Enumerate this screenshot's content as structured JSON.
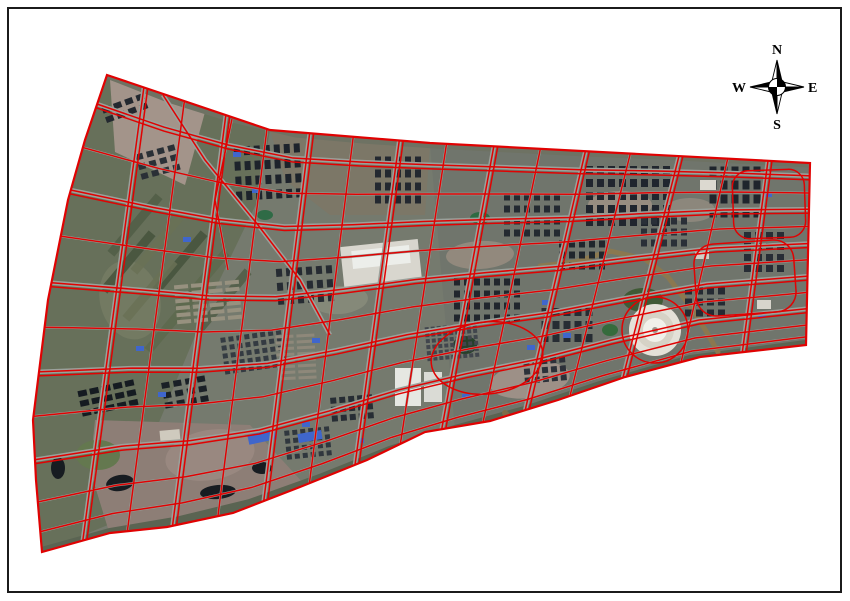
{
  "figure": {
    "type": "satellite-parcel-map",
    "bg": "#ffffff",
    "frame": {
      "inset": 8,
      "width": 833,
      "height": 584,
      "border_color": "#1b1b1b",
      "border_width": 2
    }
  },
  "compass": {
    "cx": 777,
    "cy": 87,
    "arm": 27,
    "circle_r": 8.5,
    "color": "#000000",
    "labels": {
      "north": "N",
      "south": "S",
      "east": "E",
      "west": "W"
    }
  },
  "map": {
    "base_color": "#757a6e",
    "boundary_color": "#e00202",
    "road_color": "#9ba19b",
    "outline": [
      [
        107,
        75
      ],
      [
        270,
        130
      ],
      [
        430,
        143
      ],
      [
        810,
        163
      ],
      [
        806,
        345
      ],
      [
        700,
        357
      ],
      [
        625,
        377
      ],
      [
        558,
        400
      ],
      [
        490,
        421
      ],
      [
        425,
        432
      ],
      [
        367,
        460
      ],
      [
        300,
        487
      ],
      [
        233,
        513
      ],
      [
        167,
        527
      ],
      [
        110,
        533
      ],
      [
        42,
        552
      ],
      [
        36,
        480
      ],
      [
        33,
        420
      ],
      [
        48,
        300
      ],
      [
        68,
        200
      ],
      [
        85,
        140
      ]
    ],
    "grid": {
      "top": [
        [
          107,
          75
        ],
        [
          168,
          99
        ],
        [
          232,
          119
        ],
        [
          296,
          134
        ],
        [
          363,
          140
        ],
        [
          435,
          145
        ],
        [
          510,
          149
        ],
        [
          585,
          153
        ],
        [
          660,
          156
        ],
        [
          735,
          160
        ],
        [
          808,
          164
        ]
      ],
      "bottom": [
        [
          42,
          552
        ],
        [
          110,
          533
        ],
        [
          180,
          521
        ],
        [
          250,
          504
        ],
        [
          320,
          479
        ],
        [
          390,
          451
        ],
        [
          455,
          430
        ],
        [
          525,
          411
        ],
        [
          600,
          386
        ],
        [
          690,
          360
        ],
        [
          806,
          345
        ]
      ],
      "verticals": [
        {
          "u": 0.06,
          "major": true
        },
        {
          "u": 0.125,
          "major": false
        },
        {
          "u": 0.19,
          "major": true
        },
        {
          "u": 0.255,
          "major": false
        },
        {
          "u": 0.32,
          "major": true
        },
        {
          "u": 0.385,
          "major": false
        },
        {
          "u": 0.45,
          "major": true
        },
        {
          "u": 0.515,
          "major": false
        },
        {
          "u": 0.578,
          "major": true
        },
        {
          "u": 0.64,
          "major": false
        },
        {
          "u": 0.7,
          "major": true
        },
        {
          "u": 0.76,
          "major": false
        },
        {
          "u": 0.825,
          "major": true
        },
        {
          "u": 0.89,
          "major": false
        },
        {
          "u": 0.945,
          "major": true
        }
      ],
      "horizontals": [
        {
          "v": 0.065,
          "major": true
        },
        {
          "v": 0.16,
          "major": false
        },
        {
          "v": 0.25,
          "major": true
        },
        {
          "v": 0.345,
          "major": false
        },
        {
          "v": 0.44,
          "major": true
        },
        {
          "v": 0.53,
          "major": false
        },
        {
          "v": 0.62,
          "major": true
        },
        {
          "v": 0.71,
          "major": false
        },
        {
          "v": 0.8,
          "major": true
        },
        {
          "v": 0.89,
          "major": false
        },
        {
          "v": 0.955,
          "major": false
        }
      ]
    },
    "zones": [
      {
        "points": [
          [
            107,
            75
          ],
          [
            270,
            130
          ],
          [
            258,
            200
          ],
          [
            210,
            300
          ],
          [
            160,
            420
          ],
          [
            120,
            520
          ],
          [
            42,
            552
          ],
          [
            33,
            420
          ],
          [
            48,
            300
          ],
          [
            68,
            200
          ],
          [
            85,
            140
          ]
        ],
        "fill": "#67705a"
      },
      {
        "points": [
          [
            270,
            130
          ],
          [
            430,
            145
          ],
          [
            425,
            215
          ],
          [
            330,
            215
          ],
          [
            285,
            180
          ]
        ],
        "fill": "#7c7767"
      },
      {
        "points": [
          [
            430,
            145
          ],
          [
            808,
            164
          ],
          [
            806,
            345
          ],
          [
            690,
            360
          ],
          [
            560,
            398
          ],
          [
            455,
            430
          ]
        ],
        "fill": "#70756c"
      },
      {
        "points": [
          [
            110,
            80
          ],
          [
            205,
            112
          ],
          [
            185,
            185
          ],
          [
            115,
            152
          ]
        ],
        "fill": "#a3948a"
      },
      {
        "points": [
          [
            95,
            420
          ],
          [
            250,
            425
          ],
          [
            305,
            485
          ],
          [
            230,
            515
          ],
          [
            110,
            535
          ],
          [
            90,
            470
          ]
        ],
        "fill": "#8d7e76"
      }
    ],
    "bands": {
      "top_color": "#6e7263",
      "top_width": 7,
      "bottom_color": "#5a6452",
      "bottom_width": 10
    },
    "patches": [
      {
        "cx": 530,
        "cy": 380,
        "rx": 40,
        "ry": 18,
        "rot": -8,
        "fill": "#a2938b"
      },
      {
        "cx": 620,
        "cy": 205,
        "rx": 32,
        "ry": 14,
        "rot": 0,
        "fill": "#9b9083"
      },
      {
        "cx": 480,
        "cy": 255,
        "rx": 34,
        "ry": 14,
        "rot": -3,
        "fill": "#968c80"
      },
      {
        "cx": 210,
        "cy": 455,
        "rx": 45,
        "ry": 25,
        "rot": -10,
        "fill": "#9a8a82"
      },
      {
        "cx": 130,
        "cy": 300,
        "rx": 30,
        "ry": 40,
        "rot": -15,
        "fill": "#747b63"
      },
      {
        "cx": 690,
        "cy": 210,
        "rx": 25,
        "ry": 12,
        "rot": 0,
        "fill": "#8f8a7e"
      },
      {
        "cx": 340,
        "cy": 300,
        "rx": 28,
        "ry": 14,
        "rot": -5,
        "fill": "#878b7a"
      }
    ],
    "strips": {
      "w": 75,
      "h": 9,
      "rot": -50,
      "colors": [
        "#515d46",
        "#6a7156",
        "#45523c",
        "#5d684e"
      ],
      "centers": [
        [
          135,
          225
        ],
        [
          158,
          243
        ],
        [
          180,
          262
        ],
        [
          202,
          281
        ],
        [
          224,
          300
        ],
        [
          150,
          290
        ],
        [
          128,
          262
        ],
        [
          172,
          322
        ]
      ]
    },
    "rivers": [
      {
        "points": [
          [
            540,
            266
          ],
          [
            575,
            262
          ],
          [
            610,
            251
          ],
          [
            645,
            259
          ],
          [
            668,
            277
          ],
          [
            690,
            306
          ],
          [
            706,
            331
          ],
          [
            718,
            352
          ]
        ],
        "width": 5,
        "color": "#8a7850"
      },
      {
        "points": [
          [
            505,
            413
          ],
          [
            528,
            438
          ],
          [
            548,
            462
          ],
          [
            552,
            487
          ]
        ],
        "width": 6,
        "color": "#7c6c48"
      }
    ],
    "ponds": [
      {
        "cx": 120,
        "cy": 483,
        "rx": 14,
        "ry": 8,
        "rot": -10,
        "fill": "#171c21"
      },
      {
        "cx": 218,
        "cy": 492,
        "rx": 18,
        "ry": 7,
        "rot": -5,
        "fill": "#171c21"
      },
      {
        "cx": 262,
        "cy": 468,
        "rx": 10,
        "ry": 6,
        "rot": 0,
        "fill": "#171c21"
      },
      {
        "cx": 543,
        "cy": 482,
        "rx": 11,
        "ry": 7,
        "rot": 0,
        "fill": "#171c21"
      },
      {
        "cx": 58,
        "cy": 468,
        "rx": 7,
        "ry": 11,
        "rot": 0,
        "fill": "#171c21"
      },
      {
        "cx": 375,
        "cy": 262,
        "rx": 16,
        "ry": 7,
        "rot": -5,
        "fill": "#26402a"
      },
      {
        "cx": 465,
        "cy": 345,
        "rx": 12,
        "ry": 9,
        "rot": 0,
        "fill": "#26402a"
      }
    ],
    "greens": [
      {
        "cx": 643,
        "cy": 300,
        "rx": 20,
        "ry": 12,
        "fill": "#3f5a35"
      },
      {
        "cx": 98,
        "cy": 455,
        "rx": 22,
        "ry": 15,
        "fill": "#64784f"
      },
      {
        "cx": 480,
        "cy": 218,
        "rx": 10,
        "ry": 6,
        "fill": "#2e6b43"
      },
      {
        "cx": 265,
        "cy": 215,
        "rx": 8,
        "ry": 5,
        "fill": "#2f6b46"
      },
      {
        "cx": 610,
        "cy": 330,
        "rx": 8,
        "ry": 6,
        "fill": "#356b3c"
      }
    ],
    "lights": [
      {
        "x": 342,
        "y": 243,
        "w": 78,
        "h": 40,
        "rot": -6,
        "fill": "#d8d6ce"
      },
      {
        "x": 352,
        "y": 248,
        "w": 58,
        "h": 18,
        "rot": -6,
        "fill": "#eceeea"
      },
      {
        "x": 395,
        "y": 368,
        "w": 26,
        "h": 38,
        "rot": 0,
        "fill": "#e6e7e2"
      },
      {
        "x": 424,
        "y": 372,
        "w": 18,
        "h": 30,
        "rot": 0,
        "fill": "#dadbd5"
      },
      {
        "x": 700,
        "y": 180,
        "w": 16,
        "h": 10,
        "rot": 0,
        "fill": "#dcd9d0"
      },
      {
        "x": 757,
        "y": 300,
        "w": 14,
        "h": 9,
        "rot": 0,
        "fill": "#d8d5cc"
      },
      {
        "x": 160,
        "y": 430,
        "w": 20,
        "h": 12,
        "rot": -5,
        "fill": "#cfcabe"
      },
      {
        "x": 695,
        "y": 250,
        "w": 14,
        "h": 9,
        "rot": 0,
        "fill": "#d2cfc6"
      }
    ],
    "blue_roofs": {
      "color": "#3f66cc",
      "w": 8,
      "h": 5,
      "items": [
        {
          "x": 252,
          "y": 188
        },
        {
          "x": 183,
          "y": 237
        },
        {
          "x": 312,
          "y": 338
        },
        {
          "x": 356,
          "y": 438
        },
        {
          "x": 428,
          "y": 440
        },
        {
          "x": 527,
          "y": 345
        },
        {
          "x": 563,
          "y": 333
        },
        {
          "x": 758,
          "y": 312
        },
        {
          "x": 302,
          "y": 422
        },
        {
          "x": 233,
          "y": 152
        },
        {
          "x": 462,
          "y": 394
        },
        {
          "x": 764,
          "y": 192
        },
        {
          "x": 136,
          "y": 346
        },
        {
          "x": 158,
          "y": 392
        },
        {
          "x": 542,
          "y": 300
        },
        {
          "x": 248,
          "y": 432,
          "w": 28,
          "h": 10,
          "rot": -12
        },
        {
          "x": 298,
          "y": 432,
          "w": 24,
          "h": 9,
          "rot": -10
        }
      ]
    },
    "clusters": [
      {
        "x": 268,
        "y": 172,
        "c": 7,
        "r": 4,
        "w": 6,
        "h": 9,
        "gx": 4,
        "gy": 6,
        "a": -3,
        "f": "#1d232b"
      },
      {
        "x": 398,
        "y": 180,
        "c": 5,
        "r": 4,
        "w": 6,
        "h": 8,
        "gx": 4,
        "gy": 5,
        "a": 0,
        "f": "#232830"
      },
      {
        "x": 628,
        "y": 196,
        "c": 8,
        "r": 5,
        "w": 7,
        "h": 8,
        "gx": 4,
        "gy": 5,
        "a": 0,
        "f": "#20262e"
      },
      {
        "x": 735,
        "y": 192,
        "c": 5,
        "r": 4,
        "w": 7,
        "h": 9,
        "gx": 4,
        "gy": 5,
        "a": 0,
        "f": "#1f252c"
      },
      {
        "x": 305,
        "y": 285,
        "c": 6,
        "r": 3,
        "w": 6,
        "h": 8,
        "gx": 4,
        "gy": 6,
        "a": -4,
        "f": "#262b32"
      },
      {
        "x": 487,
        "y": 300,
        "c": 7,
        "r": 4,
        "w": 6,
        "h": 7,
        "gx": 4,
        "gy": 5,
        "a": 0,
        "f": "#21262d"
      },
      {
        "x": 567,
        "y": 325,
        "c": 5,
        "r": 3,
        "w": 7,
        "h": 8,
        "gx": 4,
        "gy": 5,
        "a": 0,
        "f": "#262c33"
      },
      {
        "x": 452,
        "y": 342,
        "c": 9,
        "r": 6,
        "w": 4,
        "h": 4,
        "gx": 2,
        "gy": 2,
        "a": -5,
        "f": "#41464d"
      },
      {
        "x": 253,
        "y": 352,
        "c": 8,
        "r": 5,
        "w": 5,
        "h": 5,
        "gx": 3,
        "gy": 3,
        "a": -8,
        "f": "#343b42"
      },
      {
        "x": 185,
        "y": 392,
        "c": 4,
        "r": 3,
        "w": 8,
        "h": 6,
        "gx": 4,
        "gy": 4,
        "a": -10,
        "f": "#1a2026"
      },
      {
        "x": 108,
        "y": 398,
        "c": 5,
        "r": 3,
        "w": 9,
        "h": 6,
        "gx": 3,
        "gy": 4,
        "a": -12,
        "f": "#151b21"
      },
      {
        "x": 308,
        "y": 443,
        "c": 6,
        "r": 4,
        "w": 5,
        "h": 5,
        "gx": 3,
        "gy": 3,
        "a": -6,
        "f": "#30373e"
      },
      {
        "x": 705,
        "y": 302,
        "c": 4,
        "r": 3,
        "w": 7,
        "h": 7,
        "gx": 4,
        "gy": 4,
        "a": 0,
        "f": "#252b33"
      },
      {
        "x": 764,
        "y": 252,
        "c": 4,
        "r": 4,
        "w": 7,
        "h": 7,
        "gx": 4,
        "gy": 4,
        "a": 0,
        "f": "#272d35"
      },
      {
        "x": 664,
        "y": 232,
        "c": 5,
        "r": 3,
        "w": 6,
        "h": 7,
        "gx": 4,
        "gy": 4,
        "a": 0,
        "f": "#2a3038"
      },
      {
        "x": 208,
        "y": 302,
        "c": 4,
        "r": 6,
        "w": 14,
        "h": 4,
        "gx": 3,
        "gy": 3,
        "a": -5,
        "f": "#97917f"
      },
      {
        "x": 296,
        "y": 357,
        "c": 2,
        "r": 8,
        "w": 18,
        "h": 3,
        "gx": 3,
        "gy": 3,
        "a": -3,
        "f": "#8e887a"
      },
      {
        "x": 532,
        "y": 215,
        "c": 6,
        "r": 4,
        "w": 6,
        "h": 7,
        "gx": 4,
        "gy": 5,
        "a": 0,
        "f": "#242a31"
      },
      {
        "x": 582,
        "y": 255,
        "c": 5,
        "r": 3,
        "w": 6,
        "h": 7,
        "gx": 4,
        "gy": 4,
        "a": 0,
        "f": "#20262d"
      },
      {
        "x": 158,
        "y": 162,
        "c": 4,
        "r": 3,
        "w": 7,
        "h": 6,
        "gx": 4,
        "gy": 4,
        "a": -15,
        "f": "#2a3036"
      },
      {
        "x": 125,
        "y": 108,
        "c": 4,
        "r": 2,
        "w": 8,
        "h": 6,
        "gx": 4,
        "gy": 4,
        "a": -20,
        "f": "#23282f"
      },
      {
        "x": 545,
        "y": 370,
        "c": 5,
        "r": 3,
        "w": 6,
        "h": 6,
        "gx": 3,
        "gy": 3,
        "a": -5,
        "f": "#2c3139"
      },
      {
        "x": 352,
        "y": 408,
        "c": 5,
        "r": 3,
        "w": 6,
        "h": 6,
        "gx": 3,
        "gy": 3,
        "a": -5,
        "f": "#272d34"
      }
    ],
    "diagonals": [
      {
        "points": [
          [
            163,
            95
          ],
          [
            205,
            160
          ],
          [
            258,
            225
          ],
          [
            300,
            280
          ],
          [
            330,
            335
          ]
        ],
        "major": true
      },
      {
        "points": [
          [
            232,
            119
          ],
          [
            215,
            200
          ],
          [
            228,
            270
          ]
        ],
        "major": false
      }
    ],
    "red_shapes": [
      {
        "type": "rect",
        "x": 733,
        "y": 170,
        "w": 72,
        "h": 68,
        "rx": 16,
        "rot": -2
      },
      {
        "type": "rect",
        "x": 695,
        "y": 242,
        "w": 100,
        "h": 72,
        "rx": 20,
        "rot": -4
      },
      {
        "type": "circle",
        "cx": 655,
        "cy": 330,
        "r": 33
      },
      {
        "type": "ellipse",
        "cx": 487,
        "cy": 358,
        "rx": 56,
        "ry": 36,
        "rot": -6
      }
    ],
    "plaza": {
      "cx": 655,
      "cy": 330,
      "r": 26,
      "ring_r": 19,
      "core_r": 12,
      "dot_r": 3,
      "fill": "#e4e1d8",
      "ring": "#d6d2c6",
      "core": "#f1f0ea",
      "dot": "#9a958c"
    }
  }
}
